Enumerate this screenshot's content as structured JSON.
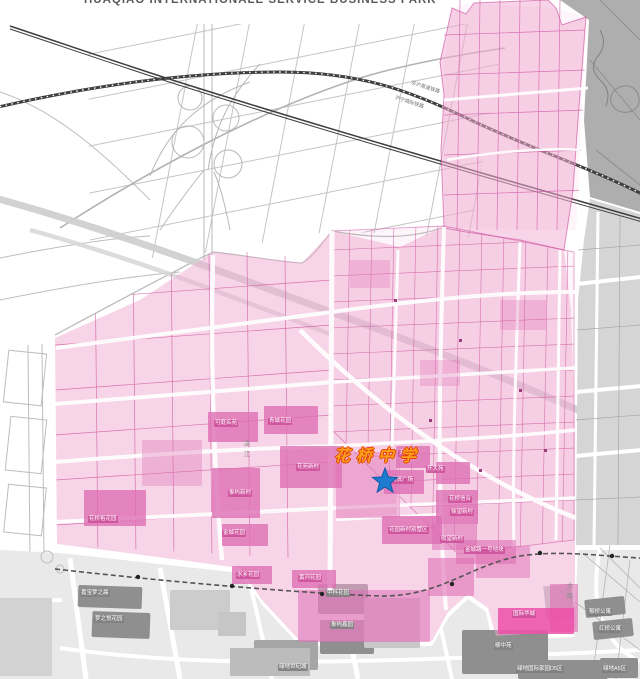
{
  "header": {
    "title": "HUAQIAO INTERNATIONALE SERVICE BUSINESS PARK"
  },
  "school": {
    "name": "花桥中学"
  },
  "marker": {
    "type": "star",
    "description": "school-location"
  },
  "railway_labels": [
    {
      "text": "京沪高速铁路",
      "x": 412,
      "y": 80,
      "rotate": 18
    },
    {
      "text": "沪宁城际铁路",
      "x": 396,
      "y": 95,
      "rotate": 18
    }
  ],
  "street_names": [
    {
      "text": "凌江",
      "x": 242,
      "y": 440
    },
    {
      "text": "大商",
      "x": 565,
      "y": 582
    }
  ],
  "labels": {
    "estates": [
      {
        "text": "可庭名苑",
        "x": 214,
        "y": 420
      },
      {
        "text": "青城花园",
        "x": 268,
        "y": 418
      },
      {
        "text": "花苑新村",
        "x": 296,
        "y": 464
      },
      {
        "text": "象屿新村",
        "x": 228,
        "y": 490
      },
      {
        "text": "花桥裕花园",
        "x": 88,
        "y": 516
      },
      {
        "text": "金城花园",
        "x": 222,
        "y": 530
      },
      {
        "text": "水乡花园",
        "x": 236,
        "y": 572
      },
      {
        "text": "黄河花园",
        "x": 298,
        "y": 575
      },
      {
        "text": "天福苑",
        "x": 398,
        "y": 450
      },
      {
        "text": "商贸广场",
        "x": 390,
        "y": 477
      },
      {
        "text": "升大苑",
        "x": 426,
        "y": 466
      },
      {
        "text": "花桥信合",
        "x": 448,
        "y": 496
      },
      {
        "text": "徐望新村",
        "x": 450,
        "y": 509
      },
      {
        "text": "花园新村别墅区",
        "x": 388,
        "y": 527
      },
      {
        "text": "收望新村",
        "x": 440,
        "y": 536
      },
      {
        "text": "金城路一号地块",
        "x": 464,
        "y": 547
      },
      {
        "text": "国际华城",
        "x": 512,
        "y": 611
      }
    ],
    "neighborhoods": [
      {
        "text": "嘉宝梦之晨",
        "x": 80,
        "y": 590
      },
      {
        "text": "梦之悦花园",
        "x": 94,
        "y": 616
      },
      {
        "text": "中科花园",
        "x": 326,
        "y": 590
      },
      {
        "text": "象屿鑫园",
        "x": 330,
        "y": 622
      },
      {
        "text": "柳中苑",
        "x": 494,
        "y": 643
      },
      {
        "text": "绿地国际家园D5区",
        "x": 516,
        "y": 666
      },
      {
        "text": "绿地A5区",
        "x": 602,
        "y": 666
      },
      {
        "text": "郁桥公寓",
        "x": 588,
        "y": 609
      },
      {
        "text": "红桥公寓",
        "x": 598,
        "y": 626
      },
      {
        "text": "绿地世纪城",
        "x": 278,
        "y": 664
      }
    ]
  },
  "colors": {
    "district_pink": "#F2A9D2",
    "estate_dark_pink": "#DD6FB4",
    "parcel_outline": "#CC539B",
    "bright_magenta": "#EC4FA8",
    "star_blue": "#1E7BD0",
    "school_orange": "#FFA01E",
    "school_outline_red": "#E03A00",
    "railway_dark": "#3F3F3F",
    "building_gray": "#8F8F8F",
    "zone_gray": "#D5D5D5"
  }
}
